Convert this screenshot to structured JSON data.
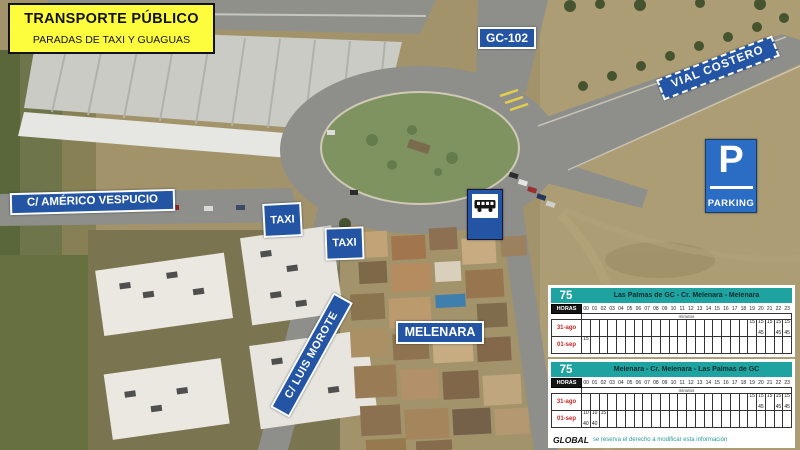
{
  "title_box": {
    "line1": "TRANSPORTE PÚBLICO",
    "line2": "PARADAS DE TAXI Y GUAGUAS"
  },
  "road_labels": {
    "gc102": "GC-102",
    "vial_costero": "VIAL COSTERO",
    "americo_vespucio": "C/ AMÉRICO VESPUCIO",
    "luis_morote": "C/ LUIS MOROTE",
    "melenara": "MELENARA"
  },
  "stop_signs": {
    "taxi_north": "TAXI",
    "taxi_south": "TAXI",
    "bus_stop": "bus-icon"
  },
  "parking_sign": {
    "symbol": "P",
    "label": "PARKING"
  },
  "colors": {
    "sign_blue": "#2455A4",
    "parking_blue": "#2B6CC4",
    "teal_header": "#1FA3A0",
    "highlight_yellow": "#FDFD3D",
    "schedule_red": "#C22727"
  },
  "schedules": {
    "hours_label": "HORAS",
    "minutes_label": "minutos",
    "hours": [
      "00",
      "01",
      "02",
      "03",
      "04",
      "05",
      "06",
      "07",
      "08",
      "09",
      "10",
      "11",
      "12",
      "13",
      "14",
      "15",
      "16",
      "17",
      "18",
      "19",
      "20",
      "21",
      "22",
      "23"
    ],
    "tables": [
      {
        "route_number": "75",
        "route_name": "Las Palmas de GC - Cr. Melenara - Melenara",
        "rows": [
          {
            "label": "31-ago",
            "cells": {
              "19": [
                "15"
              ],
              "20": [
                "15",
                "45"
              ],
              "21": [
                "15"
              ],
              "22": [
                "15",
                "45"
              ],
              "23": [
                "15",
                "45"
              ]
            }
          },
          {
            "label": "01-sep",
            "cells": {
              "00": [
                "15"
              ]
            }
          }
        ]
      },
      {
        "route_number": "75",
        "route_name": "Melenara - Cr. Melenara - Las Palmas de GC",
        "rows": [
          {
            "label": "31-ago",
            "cells": {
              "19": [
                "15"
              ],
              "20": [
                "15",
                "45"
              ],
              "21": [
                "15"
              ],
              "22": [
                "15",
                "45"
              ],
              "23": [
                "15",
                "45"
              ]
            }
          },
          {
            "label": "01-sep",
            "cells": {
              "00": [
                "10",
                "40"
              ],
              "01": [
                "10",
                "40"
              ],
              "02": [
                "15"
              ]
            }
          }
        ]
      }
    ],
    "footer": {
      "brand": "GLOBAL",
      "disclaimer": "se reserva el derecho a modificar esta información"
    }
  }
}
